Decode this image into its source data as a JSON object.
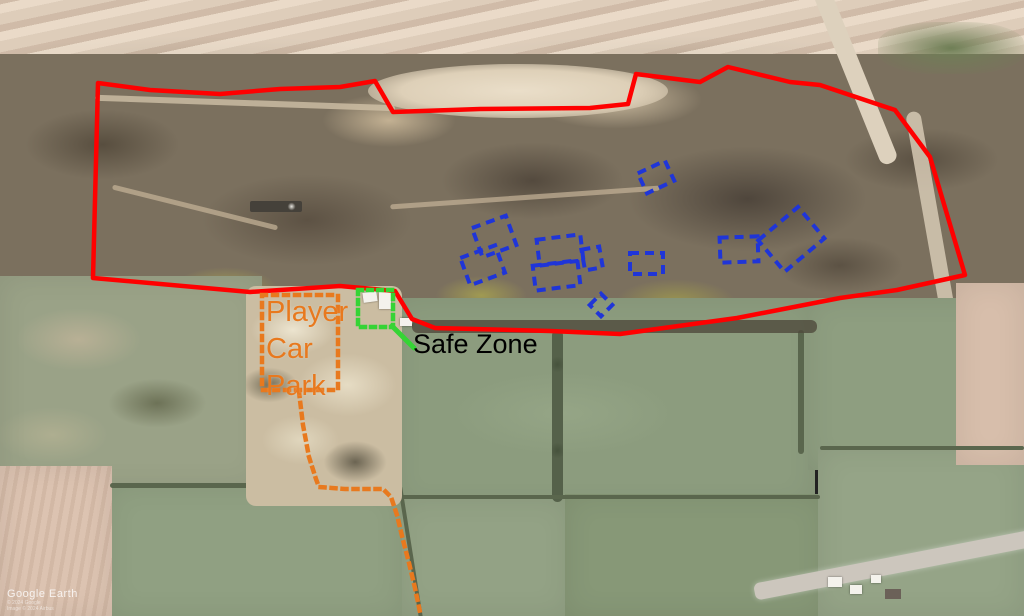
{
  "annotations": {
    "car_park_label": {
      "line1": "Player",
      "line2": "Car",
      "line3": "Park"
    },
    "safe_zone_label": "Safe Zone"
  },
  "colors": {
    "site_boundary": "#ff0000",
    "game_zone": "#1f35d8",
    "car_park": "#e8791e",
    "safe_zone": "#35d435",
    "safe_zone_text": "#000000"
  },
  "attribution": {
    "brand": "Google Earth",
    "copyright": "© 2024 Google",
    "imagery": "Image © 2024 Airbus"
  }
}
